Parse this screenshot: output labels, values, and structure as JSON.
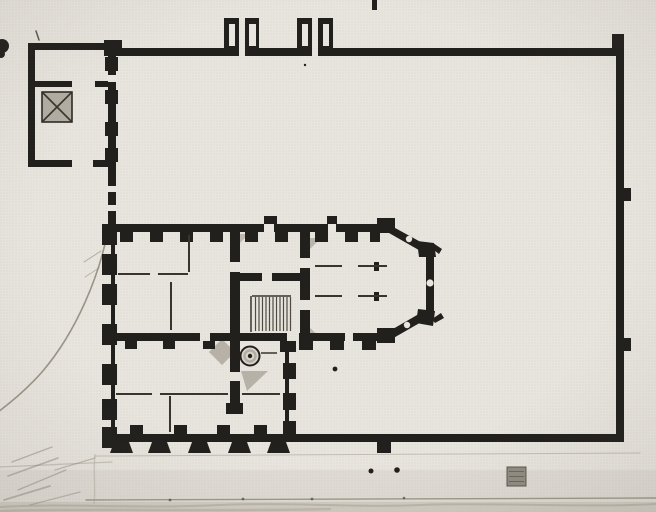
{
  "meta": {
    "description": "Halftone book reproduction of an architectural ground plan: a walled rectangular courtyard with two gate piers on the north wall, a small square pavilion with a hatched stair at the north-west corner, and a multi-room palazzo block with a polygonal apse, interior stair hall, spiral-stair circle and crenellated pier facades occupying the south-west part of the enclosure; faint pencil sketch lines along the left and bottom margins.",
    "canvas": {
      "w": 656,
      "h": 512
    }
  },
  "palette": {
    "paper": "#e8e5de",
    "ink": "#22201d",
    "thin": "#38352e",
    "hatch": "#4e4a41",
    "gray": "#a39d92",
    "gray2": "#b2ada3",
    "graysq": "#918c82",
    "graysq_s": "#5a564e",
    "pencil": "#8d8679",
    "pencil_soft": "#a69f92",
    "pencil_dark": "#5d5850",
    "wash": "#b3ad9f",
    "circle_fill": "#d8d4cc",
    "ring": "#aaa49a"
  },
  "plan": {
    "washes": [
      {
        "x": 0,
        "y": 470,
        "w": 656,
        "h": 42,
        "f": "gray2",
        "o": 0.14
      },
      {
        "x": 0,
        "y": 502,
        "w": 656,
        "h": 10,
        "f": "wash",
        "o": 0.33
      }
    ],
    "pencil": [
      {
        "d": "M107,235 C99,274 78,330 42,372 C27,389 10,403 -2,412",
        "w": 1.6,
        "c": "pencil",
        "o": 0.85
      },
      {
        "d": "M84,262 L101,251",
        "w": 1,
        "c": "pencil",
        "o": 0.6
      },
      {
        "d": "M85,277 L99,268",
        "w": 1,
        "c": "pencil",
        "o": 0.5
      },
      {
        "d": "M95,456 L640,453",
        "w": 1,
        "c": "pencil_soft",
        "o": 0.55
      },
      {
        "d": "M0,467 L112,462",
        "w": 1.2,
        "c": "pencil_soft",
        "o": 0.5
      },
      {
        "d": "M86,500 L656,498",
        "w": 1.4,
        "c": "pencil",
        "o": 0.8
      },
      {
        "d": "M0,507 C60,503 140,509 220,505 C290,502 360,508 420,505 C480,502 580,508 656,504",
        "w": 2,
        "c": "pencil_soft",
        "o": 0.5
      },
      {
        "d": "M0,511 C80,508 200,512 330,509",
        "w": 2.5,
        "c": "pencil_soft",
        "o": 0.45
      },
      {
        "d": "M12,462 L52,447",
        "w": 1.4,
        "c": "pencil",
        "o": 0.5
      },
      {
        "d": "M8,476 L58,458",
        "w": 1.6,
        "c": "pencil",
        "o": 0.5
      },
      {
        "d": "M18,490 L66,470",
        "w": 1.4,
        "c": "pencil",
        "o": 0.5
      },
      {
        "d": "M4,500 L50,486",
        "w": 1.8,
        "c": "pencil",
        "o": 0.5
      },
      {
        "d": "M30,505 L80,492",
        "w": 1.4,
        "c": "pencil",
        "o": 0.45
      },
      {
        "d": "M55,470 L95,458",
        "w": 1.2,
        "c": "pencil",
        "o": 0.45
      },
      {
        "d": "M95,455 C93,470 96,488 94,503",
        "w": 1.5,
        "c": "pencil_soft",
        "o": 0.4
      },
      {
        "d": "M36,31 L39,40",
        "w": 1.5,
        "c": "hatch",
        "o": 0.9
      }
    ],
    "grays": [
      {
        "p": "222,339 235,352 222,365 209,352",
        "f": "gray",
        "o": 0.72
      },
      {
        "p": "241,371 268,371 247,391",
        "f": "gray",
        "o": 0.7
      },
      {
        "p": "305,238 321,238 305,254",
        "f": "gray",
        "o": 0.65
      },
      {
        "p": "306,340 323,340 306,324",
        "f": "gray",
        "o": 0.65
      },
      {
        "p": "234,234 249,234 234,249",
        "f": "gray",
        "o": 0.6
      }
    ],
    "rects": [
      {
        "x": 104,
        "y": 48,
        "w": 121,
        "h": 8,
        "f": "ink"
      },
      {
        "x": 258,
        "y": 48,
        "w": 39,
        "h": 8,
        "f": "ink"
      },
      {
        "x": 333,
        "y": 48,
        "w": 289,
        "h": 8,
        "f": "ink"
      },
      {
        "x": 612,
        "y": 34,
        "w": 12,
        "h": 14,
        "f": "ink"
      },
      {
        "x": 616,
        "y": 48,
        "w": 8,
        "h": 394,
        "f": "ink"
      },
      {
        "x": 622,
        "y": 188,
        "w": 9,
        "h": 13,
        "f": "ink"
      },
      {
        "x": 622,
        "y": 338,
        "w": 9,
        "h": 13,
        "f": "ink"
      },
      {
        "x": 104,
        "y": 434,
        "w": 518,
        "h": 8,
        "f": "ink"
      },
      {
        "x": 377,
        "y": 442,
        "w": 14,
        "h": 11,
        "f": "ink"
      },
      {
        "x": 104,
        "y": 40,
        "w": 18,
        "h": 16,
        "f": "ink"
      },
      {
        "x": 224,
        "y": 18,
        "w": 15,
        "h": 38,
        "f": "ink"
      },
      {
        "x": 245,
        "y": 18,
        "w": 14,
        "h": 38,
        "f": "ink"
      },
      {
        "x": 297,
        "y": 18,
        "w": 15,
        "h": 38,
        "f": "ink"
      },
      {
        "x": 318,
        "y": 18,
        "w": 15,
        "h": 38,
        "f": "ink"
      },
      {
        "x": 28,
        "y": 43,
        "w": 84,
        "h": 7,
        "f": "ink"
      },
      {
        "x": 28,
        "y": 43,
        "w": 7,
        "h": 124,
        "f": "ink"
      },
      {
        "x": 28,
        "y": 160,
        "w": 44,
        "h": 7,
        "f": "ink"
      },
      {
        "x": 93,
        "y": 160,
        "w": 19,
        "h": 7,
        "f": "ink"
      },
      {
        "x": 108,
        "y": 43,
        "w": 8,
        "h": 124,
        "f": "ink"
      },
      {
        "x": 105,
        "y": 57,
        "w": 13,
        "h": 14,
        "f": "ink"
      },
      {
        "x": 105,
        "y": 90,
        "w": 13,
        "h": 14,
        "f": "ink"
      },
      {
        "x": 105,
        "y": 122,
        "w": 13,
        "h": 14,
        "f": "ink"
      },
      {
        "x": 105,
        "y": 148,
        "w": 13,
        "h": 14,
        "f": "ink"
      },
      {
        "x": 35,
        "y": 81,
        "w": 37,
        "h": 6,
        "f": "ink"
      },
      {
        "x": 95,
        "y": 81,
        "w": 13,
        "h": 6,
        "f": "ink"
      },
      {
        "x": 42,
        "y": 92,
        "w": 30,
        "h": 30,
        "f": "gray2",
        "s": "ink",
        "sw": 1.5
      },
      {
        "x": 108,
        "y": 167,
        "w": 8,
        "h": 57,
        "f": "ink"
      },
      {
        "x": 104,
        "y": 224,
        "w": 286,
        "h": 8,
        "f": "ink"
      },
      {
        "x": 264,
        "y": 216,
        "w": 13,
        "h": 8,
        "f": "ink"
      },
      {
        "x": 327,
        "y": 216,
        "w": 10,
        "h": 8,
        "f": "ink"
      },
      {
        "x": 120,
        "y": 232,
        "w": 13,
        "h": 10,
        "f": "ink"
      },
      {
        "x": 150,
        "y": 232,
        "w": 13,
        "h": 10,
        "f": "ink"
      },
      {
        "x": 180,
        "y": 232,
        "w": 13,
        "h": 10,
        "f": "ink"
      },
      {
        "x": 210,
        "y": 232,
        "w": 13,
        "h": 10,
        "f": "ink"
      },
      {
        "x": 245,
        "y": 232,
        "w": 13,
        "h": 10,
        "f": "ink"
      },
      {
        "x": 275,
        "y": 232,
        "w": 13,
        "h": 10,
        "f": "ink"
      },
      {
        "x": 315,
        "y": 232,
        "w": 13,
        "h": 10,
        "f": "ink"
      },
      {
        "x": 345,
        "y": 232,
        "w": 13,
        "h": 10,
        "f": "ink"
      },
      {
        "x": 370,
        "y": 232,
        "w": 10,
        "h": 10,
        "f": "ink"
      },
      {
        "x": 111,
        "y": 222,
        "w": 4,
        "h": 226,
        "f": "ink"
      },
      {
        "x": 102,
        "y": 224,
        "w": 15,
        "h": 21,
        "f": "ink"
      },
      {
        "x": 102,
        "y": 254,
        "w": 15,
        "h": 21,
        "f": "ink"
      },
      {
        "x": 102,
        "y": 284,
        "w": 15,
        "h": 21,
        "f": "ink"
      },
      {
        "x": 102,
        "y": 324,
        "w": 15,
        "h": 21,
        "f": "ink"
      },
      {
        "x": 102,
        "y": 364,
        "w": 15,
        "h": 21,
        "f": "ink"
      },
      {
        "x": 102,
        "y": 399,
        "w": 15,
        "h": 21,
        "f": "ink"
      },
      {
        "x": 102,
        "y": 427,
        "w": 15,
        "h": 21,
        "f": "ink"
      },
      {
        "x": 230,
        "y": 232,
        "w": 10,
        "h": 30,
        "f": "ink"
      },
      {
        "x": 230,
        "y": 272,
        "w": 10,
        "h": 61,
        "f": "ink"
      },
      {
        "x": 300,
        "y": 232,
        "w": 10,
        "h": 26,
        "f": "ink"
      },
      {
        "x": 300,
        "y": 268,
        "w": 10,
        "h": 32,
        "f": "ink"
      },
      {
        "x": 300,
        "y": 310,
        "w": 10,
        "h": 23,
        "f": "ink"
      },
      {
        "x": 240,
        "y": 273,
        "w": 22,
        "h": 8,
        "f": "ink"
      },
      {
        "x": 272,
        "y": 273,
        "w": 38,
        "h": 8,
        "f": "ink"
      },
      {
        "x": 106,
        "y": 333,
        "w": 94,
        "h": 8,
        "f": "ink"
      },
      {
        "x": 210,
        "y": 333,
        "w": 77,
        "h": 8,
        "f": "ink"
      },
      {
        "x": 299,
        "y": 333,
        "w": 46,
        "h": 8,
        "f": "ink"
      },
      {
        "x": 353,
        "y": 333,
        "w": 37,
        "h": 8,
        "f": "ink"
      },
      {
        "x": 299,
        "y": 341,
        "w": 14,
        "h": 9,
        "f": "ink"
      },
      {
        "x": 330,
        "y": 341,
        "w": 14,
        "h": 9,
        "f": "ink"
      },
      {
        "x": 362,
        "y": 341,
        "w": 14,
        "h": 9,
        "f": "ink"
      },
      {
        "x": 125,
        "y": 341,
        "w": 12,
        "h": 8,
        "f": "ink"
      },
      {
        "x": 163,
        "y": 341,
        "w": 12,
        "h": 8,
        "f": "ink"
      },
      {
        "x": 203,
        "y": 341,
        "w": 12,
        "h": 8,
        "f": "ink"
      },
      {
        "x": 377,
        "y": 218,
        "w": 18,
        "h": 15,
        "f": "ink"
      },
      {
        "x": 426,
        "y": 254,
        "w": 8,
        "h": 62,
        "f": "ink"
      },
      {
        "x": 377,
        "y": 328,
        "w": 18,
        "h": 15,
        "f": "ink"
      },
      {
        "x": 374,
        "y": 262,
        "w": 5,
        "h": 9,
        "f": "ink"
      },
      {
        "x": 374,
        "y": 292,
        "w": 5,
        "h": 9,
        "f": "ink"
      },
      {
        "x": 285,
        "y": 352,
        "w": 4,
        "h": 82,
        "f": "ink"
      },
      {
        "x": 280,
        "y": 341,
        "w": 16,
        "h": 11,
        "f": "ink"
      },
      {
        "x": 283,
        "y": 363,
        "w": 13,
        "h": 16,
        "f": "ink"
      },
      {
        "x": 283,
        "y": 393,
        "w": 13,
        "h": 17,
        "f": "ink"
      },
      {
        "x": 283,
        "y": 421,
        "w": 13,
        "h": 13,
        "f": "ink"
      },
      {
        "x": 230,
        "y": 341,
        "w": 10,
        "h": 31,
        "f": "ink"
      },
      {
        "x": 230,
        "y": 381,
        "w": 10,
        "h": 30,
        "f": "ink"
      },
      {
        "x": 226,
        "y": 403,
        "w": 17,
        "h": 11,
        "f": "ink"
      },
      {
        "x": 130,
        "y": 425,
        "w": 13,
        "h": 9,
        "f": "ink"
      },
      {
        "x": 174,
        "y": 425,
        "w": 13,
        "h": 9,
        "f": "ink"
      },
      {
        "x": 217,
        "y": 425,
        "w": 13,
        "h": 9,
        "f": "ink"
      },
      {
        "x": 254,
        "y": 425,
        "w": 13,
        "h": 9,
        "f": "ink"
      },
      {
        "x": 372,
        "y": 0,
        "w": 5,
        "h": 10,
        "f": "ink"
      },
      {
        "x": 507,
        "y": 467,
        "w": 19,
        "h": 19,
        "f": "graysq",
        "s": "graysq_s",
        "sw": 1
      }
    ],
    "polys": [
      {
        "p": "386,223 428,246 424,253 382,229",
        "f": "ink"
      },
      {
        "p": "424,311 430,317 390,340 386,333",
        "f": "ink"
      },
      {
        "p": "417,241 434,243 436,257 419,257",
        "f": "ink"
      },
      {
        "p": "418,309 435,311 433,326 416,323",
        "f": "ink"
      },
      {
        "p": "433,243 442,249 439,254 430,247",
        "f": "ink"
      },
      {
        "p": "432,319 441,313 444,318 435,323",
        "f": "ink"
      },
      {
        "p": "110,453 114,442 129,442 133,453",
        "f": "ink"
      },
      {
        "p": "148,453 152,442 167,442 171,453",
        "f": "ink"
      },
      {
        "p": "188,453 192,442 207,442 211,453",
        "f": "ink"
      },
      {
        "p": "228,453 232,442 247,442 251,453",
        "f": "ink"
      },
      {
        "p": "267,453 271,442 286,442 290,453",
        "f": "ink"
      }
    ],
    "lines": [
      {
        "x1": 118,
        "y1": 274,
        "x2": 150,
        "y2": 274,
        "w": 2,
        "c": "thin"
      },
      {
        "x1": 158,
        "y1": 274,
        "x2": 188,
        "y2": 274,
        "w": 2,
        "c": "thin"
      },
      {
        "x1": 189,
        "y1": 235,
        "x2": 189,
        "y2": 272,
        "w": 2,
        "c": "thin"
      },
      {
        "x1": 171,
        "y1": 282,
        "x2": 171,
        "y2": 330,
        "w": 2,
        "c": "thin"
      },
      {
        "x1": 116,
        "y1": 394,
        "x2": 152,
        "y2": 394,
        "w": 2,
        "c": "thin"
      },
      {
        "x1": 160,
        "y1": 394,
        "x2": 228,
        "y2": 394,
        "w": 2,
        "c": "thin"
      },
      {
        "x1": 242,
        "y1": 394,
        "x2": 280,
        "y2": 394,
        "w": 2,
        "c": "thin"
      },
      {
        "x1": 170,
        "y1": 396,
        "x2": 170,
        "y2": 432,
        "w": 2,
        "c": "thin"
      },
      {
        "x1": 315,
        "y1": 266,
        "x2": 342,
        "y2": 266,
        "w": 2,
        "c": "thin"
      },
      {
        "x1": 358,
        "y1": 266,
        "x2": 387,
        "y2": 266,
        "w": 2,
        "c": "thin"
      },
      {
        "x1": 315,
        "y1": 296,
        "x2": 342,
        "y2": 296,
        "w": 2,
        "c": "thin"
      },
      {
        "x1": 358,
        "y1": 296,
        "x2": 387,
        "y2": 296,
        "w": 2,
        "c": "thin"
      },
      {
        "x1": 261,
        "y1": 353,
        "x2": 277,
        "y2": 353,
        "w": 1.5,
        "c": "thin"
      },
      {
        "x1": 252,
        "y1": 296,
        "x2": 291,
        "y2": 296,
        "w": 1.5,
        "c": "thin"
      },
      {
        "x1": 251,
        "y1": 296,
        "x2": 251,
        "y2": 332,
        "w": 1.5,
        "c": "thin"
      },
      {
        "x1": 43,
        "y1": 93,
        "x2": 71,
        "y2": 121,
        "w": 1.6,
        "c": "thin"
      },
      {
        "x1": 71,
        "y1": 93,
        "x2": 43,
        "y2": 121,
        "w": 1.6,
        "c": "thin"
      },
      {
        "x1": 255.5,
        "y1": 297,
        "x2": 255.5,
        "y2": 331,
        "w": 1.2,
        "c": "hatch"
      },
      {
        "x1": 259,
        "y1": 297,
        "x2": 259,
        "y2": 331,
        "w": 1.2,
        "c": "hatch"
      },
      {
        "x1": 262.5,
        "y1": 297,
        "x2": 262.5,
        "y2": 331,
        "w": 1.2,
        "c": "hatch"
      },
      {
        "x1": 266,
        "y1": 297,
        "x2": 266,
        "y2": 331,
        "w": 1.2,
        "c": "hatch"
      },
      {
        "x1": 269.5,
        "y1": 297,
        "x2": 269.5,
        "y2": 331,
        "w": 1.2,
        "c": "hatch"
      },
      {
        "x1": 273,
        "y1": 297,
        "x2": 273,
        "y2": 331,
        "w": 1.2,
        "c": "hatch"
      },
      {
        "x1": 276.5,
        "y1": 297,
        "x2": 276.5,
        "y2": 331,
        "w": 1.2,
        "c": "hatch"
      },
      {
        "x1": 280,
        "y1": 297,
        "x2": 280,
        "y2": 331,
        "w": 1.2,
        "c": "hatch"
      },
      {
        "x1": 283.5,
        "y1": 297,
        "x2": 283.5,
        "y2": 331,
        "w": 1.2,
        "c": "hatch"
      },
      {
        "x1": 287,
        "y1": 297,
        "x2": 287,
        "y2": 331,
        "w": 1.2,
        "c": "hatch"
      },
      {
        "x1": 290.5,
        "y1": 297,
        "x2": 290.5,
        "y2": 331,
        "w": 1.2,
        "c": "hatch"
      },
      {
        "x1": 509,
        "y1": 471.5,
        "x2": 524,
        "y2": 471.5,
        "w": 1,
        "c": "graysq_s",
        "o": 0.7
      },
      {
        "x1": 509,
        "y1": 476.5,
        "x2": 524,
        "y2": 476.5,
        "w": 1,
        "c": "graysq_s",
        "o": 0.7
      },
      {
        "x1": 509,
        "y1": 481.5,
        "x2": 524,
        "y2": 481.5,
        "w": 1,
        "c": "graysq_s",
        "o": 0.7
      }
    ],
    "circles": [
      {
        "cx": 250,
        "cy": 356,
        "r": 9.5,
        "f": "circle_fill",
        "s": "ink",
        "sw": 2
      },
      {
        "cx": 250,
        "cy": 356,
        "r": 5.5,
        "f": "none",
        "s": "ring",
        "sw": 2.5,
        "o": 0.8
      },
      {
        "cx": 250,
        "cy": 356,
        "r": 2.2,
        "f": "ink"
      },
      {
        "cx": 2,
        "cy": 46,
        "r": 7,
        "f": "ink"
      },
      {
        "cx": 1,
        "cy": 54,
        "r": 4,
        "f": "ink"
      }
    ],
    "gap_rects": [
      {
        "x": 229,
        "y": 24,
        "w": 6,
        "h": 22
      },
      {
        "x": 249,
        "y": 24,
        "w": 7,
        "h": 22
      },
      {
        "x": 302,
        "y": 24,
        "w": 6,
        "h": 22
      },
      {
        "x": 323,
        "y": 24,
        "w": 6,
        "h": 22
      },
      {
        "x": 108,
        "y": 186,
        "w": 8,
        "h": 6
      },
      {
        "x": 108,
        "y": 205,
        "w": 8,
        "h": 6
      },
      {
        "x": 108,
        "y": 75,
        "w": 8,
        "h": 7
      },
      {
        "x": 264,
        "y": 224,
        "w": 10,
        "h": 8
      },
      {
        "x": 328,
        "y": 224,
        "w": 8,
        "h": 8
      }
    ],
    "gap_dots": [
      {
        "cx": 409,
        "cy": 239,
        "r": 3.2
      },
      {
        "cx": 430,
        "cy": 283,
        "r": 3.6
      },
      {
        "cx": 407,
        "cy": 325,
        "r": 3.2
      },
      {
        "cx": 258.5,
        "cy": 356,
        "r": 2.6
      }
    ],
    "ink_dots": [
      {
        "cx": 371,
        "cy": 471,
        "r": 2.5
      },
      {
        "cx": 397,
        "cy": 470,
        "r": 2.8
      },
      {
        "cx": 335,
        "cy": 369,
        "r": 2.4
      },
      {
        "cx": 305,
        "cy": 65,
        "r": 1.2
      }
    ],
    "pencil_dots": [
      {
        "cx": 170,
        "cy": 500,
        "r": 1.4
      },
      {
        "cx": 243,
        "cy": 499,
        "r": 1.4
      },
      {
        "cx": 312,
        "cy": 499,
        "r": 1.4
      },
      {
        "cx": 404,
        "cy": 498,
        "r": 1.3
      }
    ]
  }
}
